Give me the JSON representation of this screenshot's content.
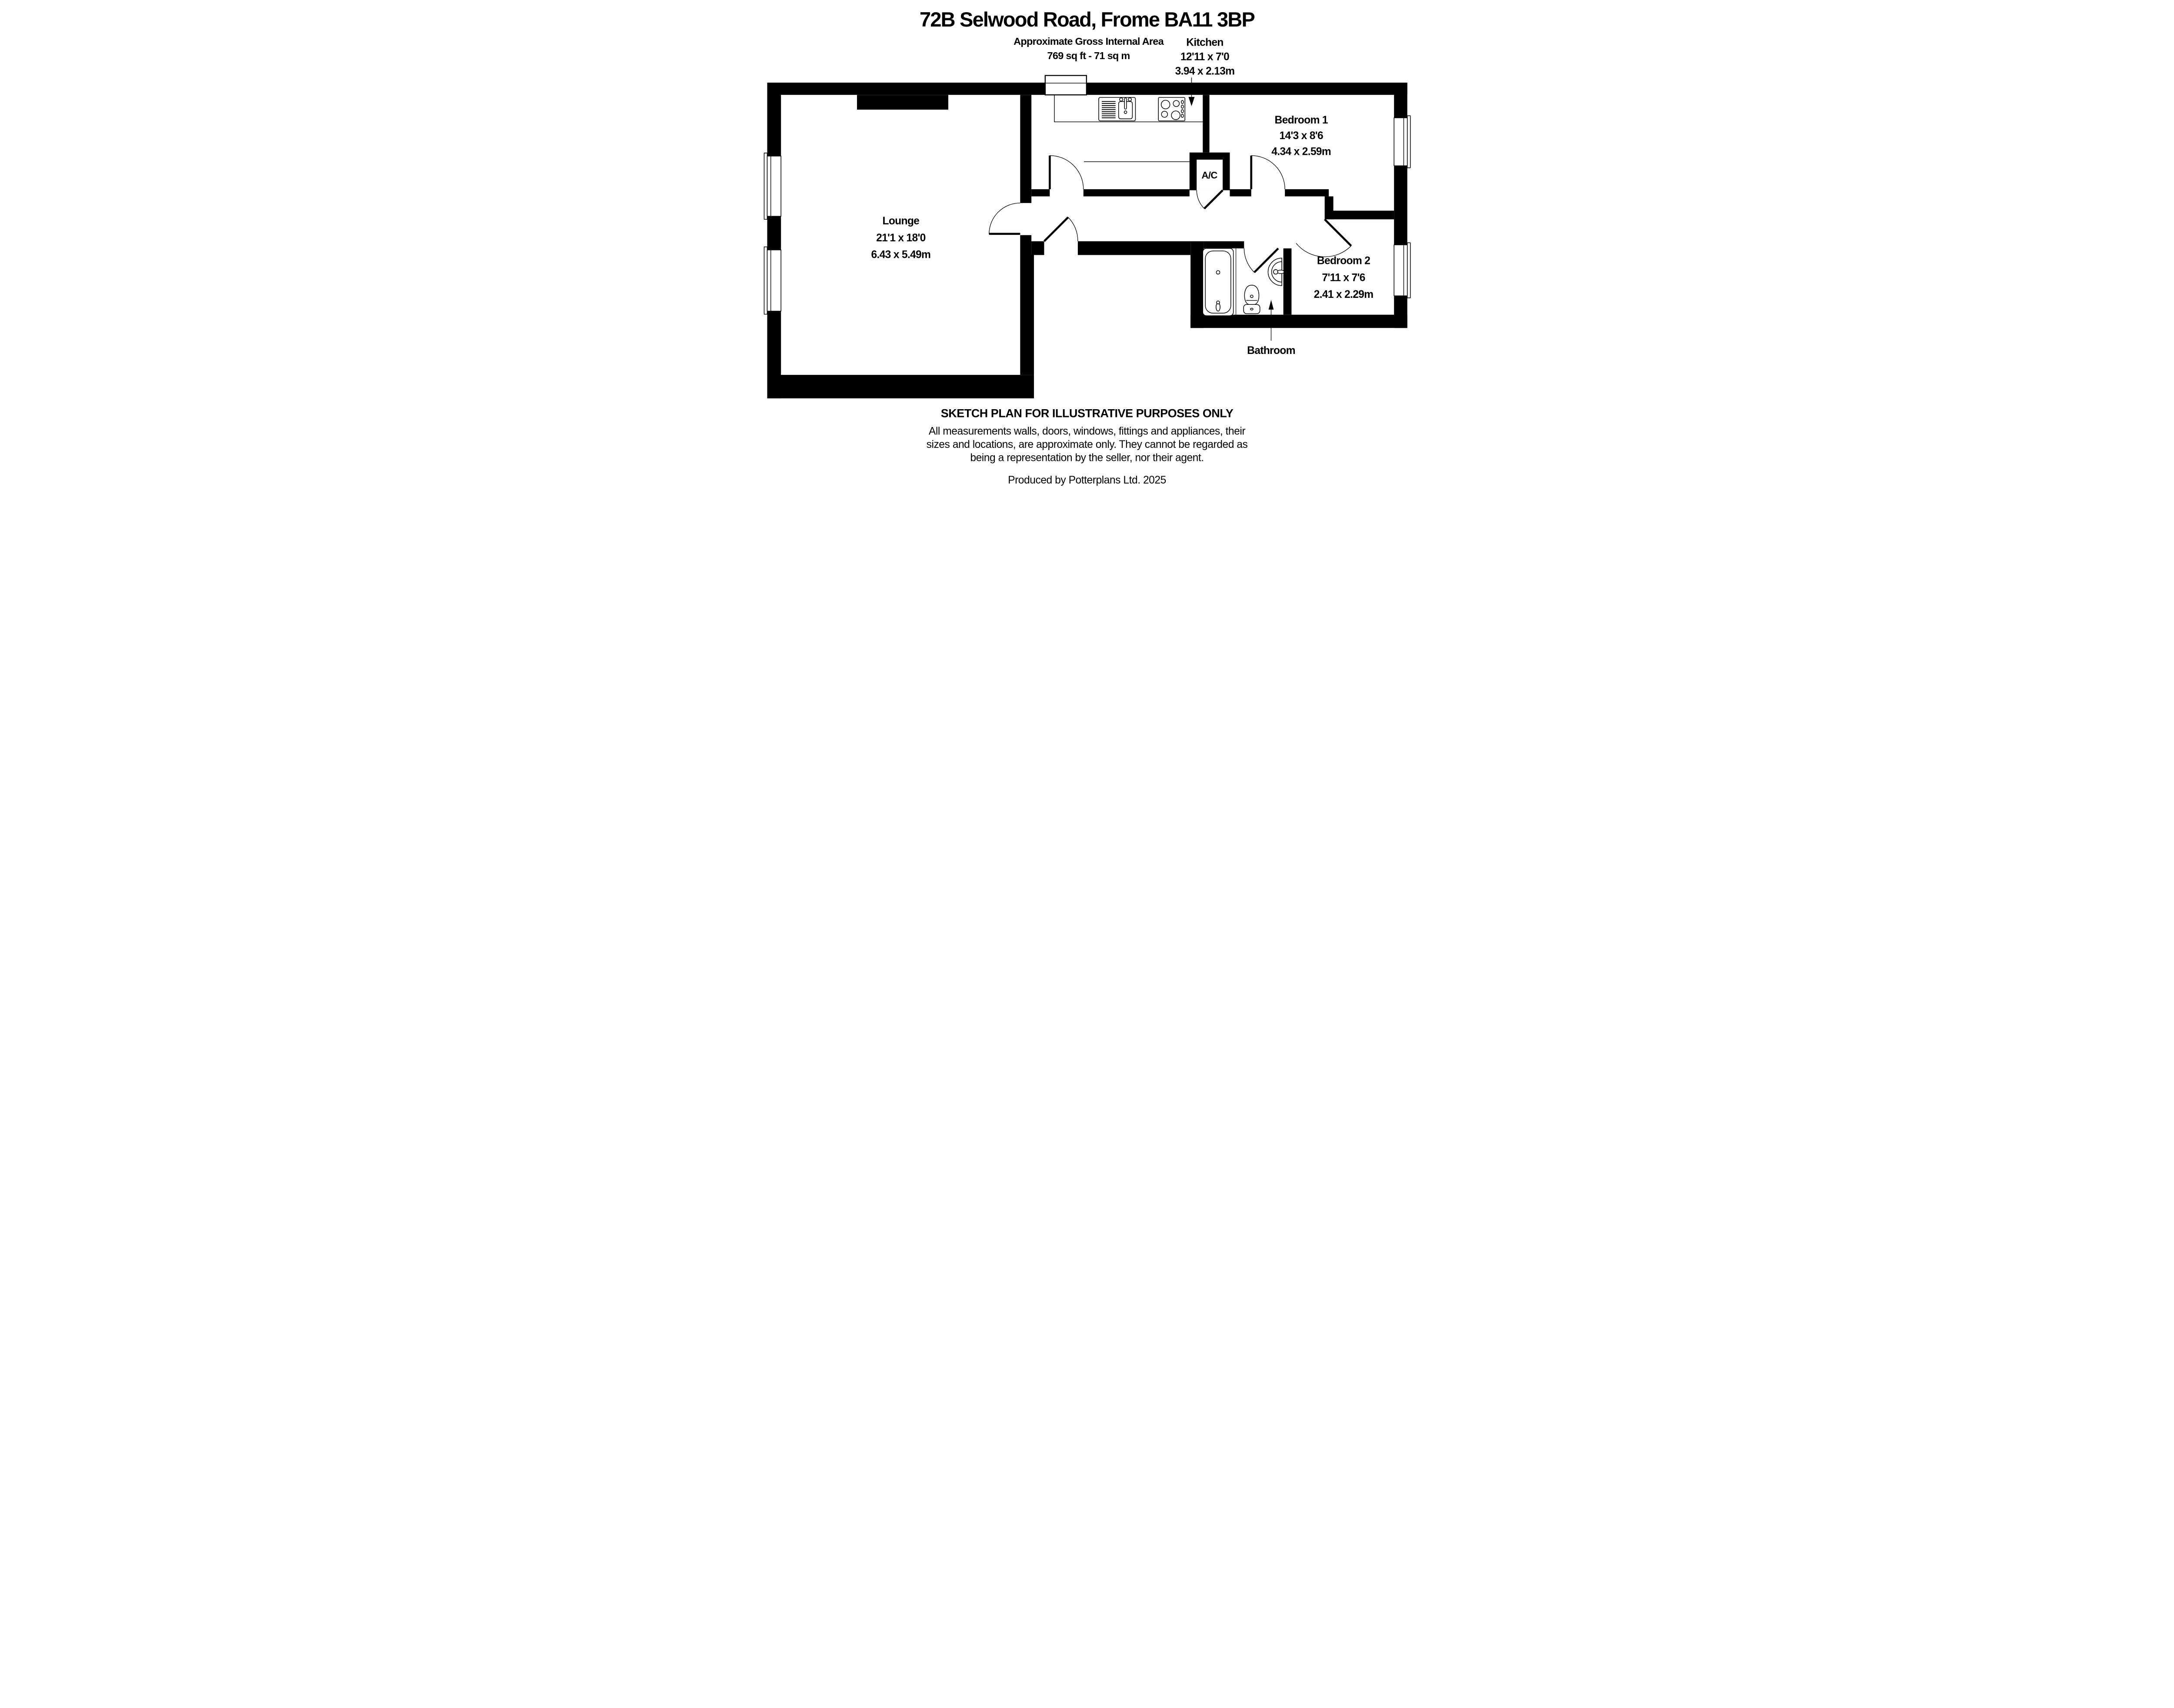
{
  "page": {
    "background": "#ffffff",
    "ink": "#000000"
  },
  "header": {
    "title": "72B Selwood Road, Frome BA11 3BP",
    "area_label": "Approximate Gross Internal Area",
    "area_value": "769 sq ft - 71 sq m"
  },
  "rooms": {
    "lounge": {
      "label": "Lounge",
      "size_imperial": "21'1 x 18'0",
      "size_metric": "6.43 x 5.49m"
    },
    "kitchen": {
      "label": "Kitchen",
      "size_imperial": "12'11 x 7'0",
      "size_metric": "3.94 x 2.13m"
    },
    "bedroom1": {
      "label": "Bedroom 1",
      "size_imperial": "14'3 x 8'6",
      "size_metric": "4.34 x 2.59m"
    },
    "bedroom2": {
      "label": "Bedroom 2",
      "size_imperial": "7'11 x 7'6",
      "size_metric": "2.41 x 2.29m"
    },
    "bathroom": {
      "label": "Bathroom"
    },
    "airing_cupboard": {
      "label": "A/C"
    }
  },
  "footer": {
    "sketch_note": "SKETCH PLAN FOR ILLUSTRATIVE PURPOSES ONLY",
    "disclaimer": [
      "All measurements walls, doors, windows, fittings and appliances, their",
      "sizes and locations, are approximate only. They cannot be regarded as",
      "being a representation by the seller, nor their agent."
    ],
    "credit": "Produced by Potterplans Ltd. 2025"
  }
}
